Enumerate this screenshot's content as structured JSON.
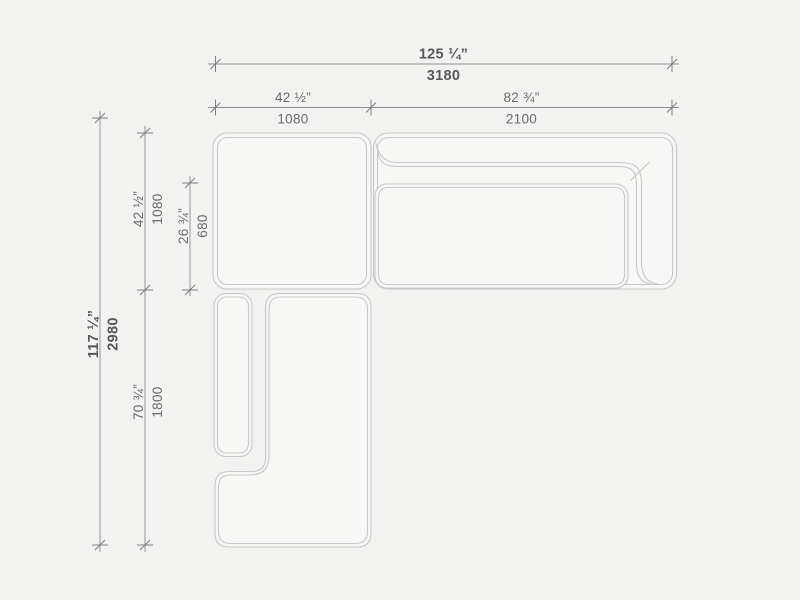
{
  "drawing": {
    "title": "sectional-sofa-top-view-dimensioned",
    "background": "#f2f2f1",
    "colors": {
      "module_fill": "#f7f7f6",
      "outline": "#c8c8c8",
      "dimension_line": "#8d8d8d",
      "label_text": "#6a6a6a",
      "label_text_strong": "#575757"
    },
    "units": [
      "inches",
      "mm"
    ],
    "dimensions": {
      "total_width": {
        "inches": "125 ¼”",
        "mm": "3180"
      },
      "left_width": {
        "inches": "42 ½”",
        "mm": "1080"
      },
      "right_width": {
        "inches": "82 ¾”",
        "mm": "2100"
      },
      "total_depth": {
        "inches": "117 ¼”",
        "mm": "2980"
      },
      "top_depth": {
        "inches": "42 ½”",
        "mm": "1080"
      },
      "seat_depth": {
        "inches": "26 ¾”",
        "mm": "680"
      },
      "chaise_depth": {
        "inches": "70 ¾”",
        "mm": "1800"
      }
    }
  }
}
